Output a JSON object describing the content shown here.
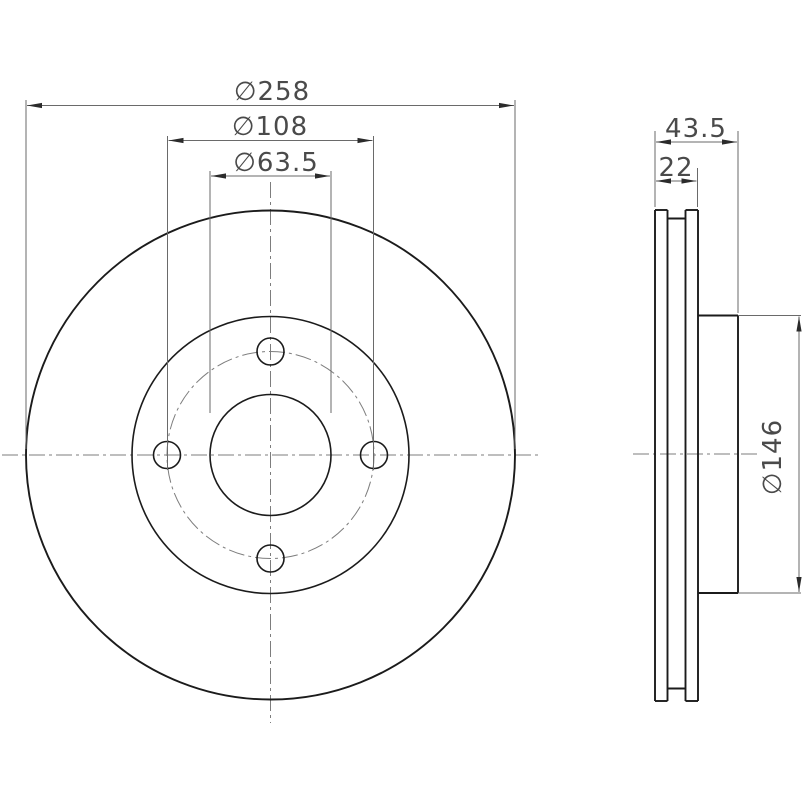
{
  "drawing_type": "brake-disc-two-view-technical-drawing",
  "colors": {
    "background": "#ffffff",
    "object_line": "#1b1b1b",
    "dimension_line": "#6a6a6a",
    "center_line": "#7d7d7d",
    "dimension_text": "#4a4a4a"
  },
  "front_view": {
    "outer_diameter_label": "∅258",
    "bolt_circle_label": "∅108",
    "center_bore_label": "∅63.5",
    "bolt_hole_count": 4
  },
  "side_view": {
    "overall_width_label": "43.5",
    "thickness_label": "22",
    "hat_diameter_label": "∅146"
  }
}
